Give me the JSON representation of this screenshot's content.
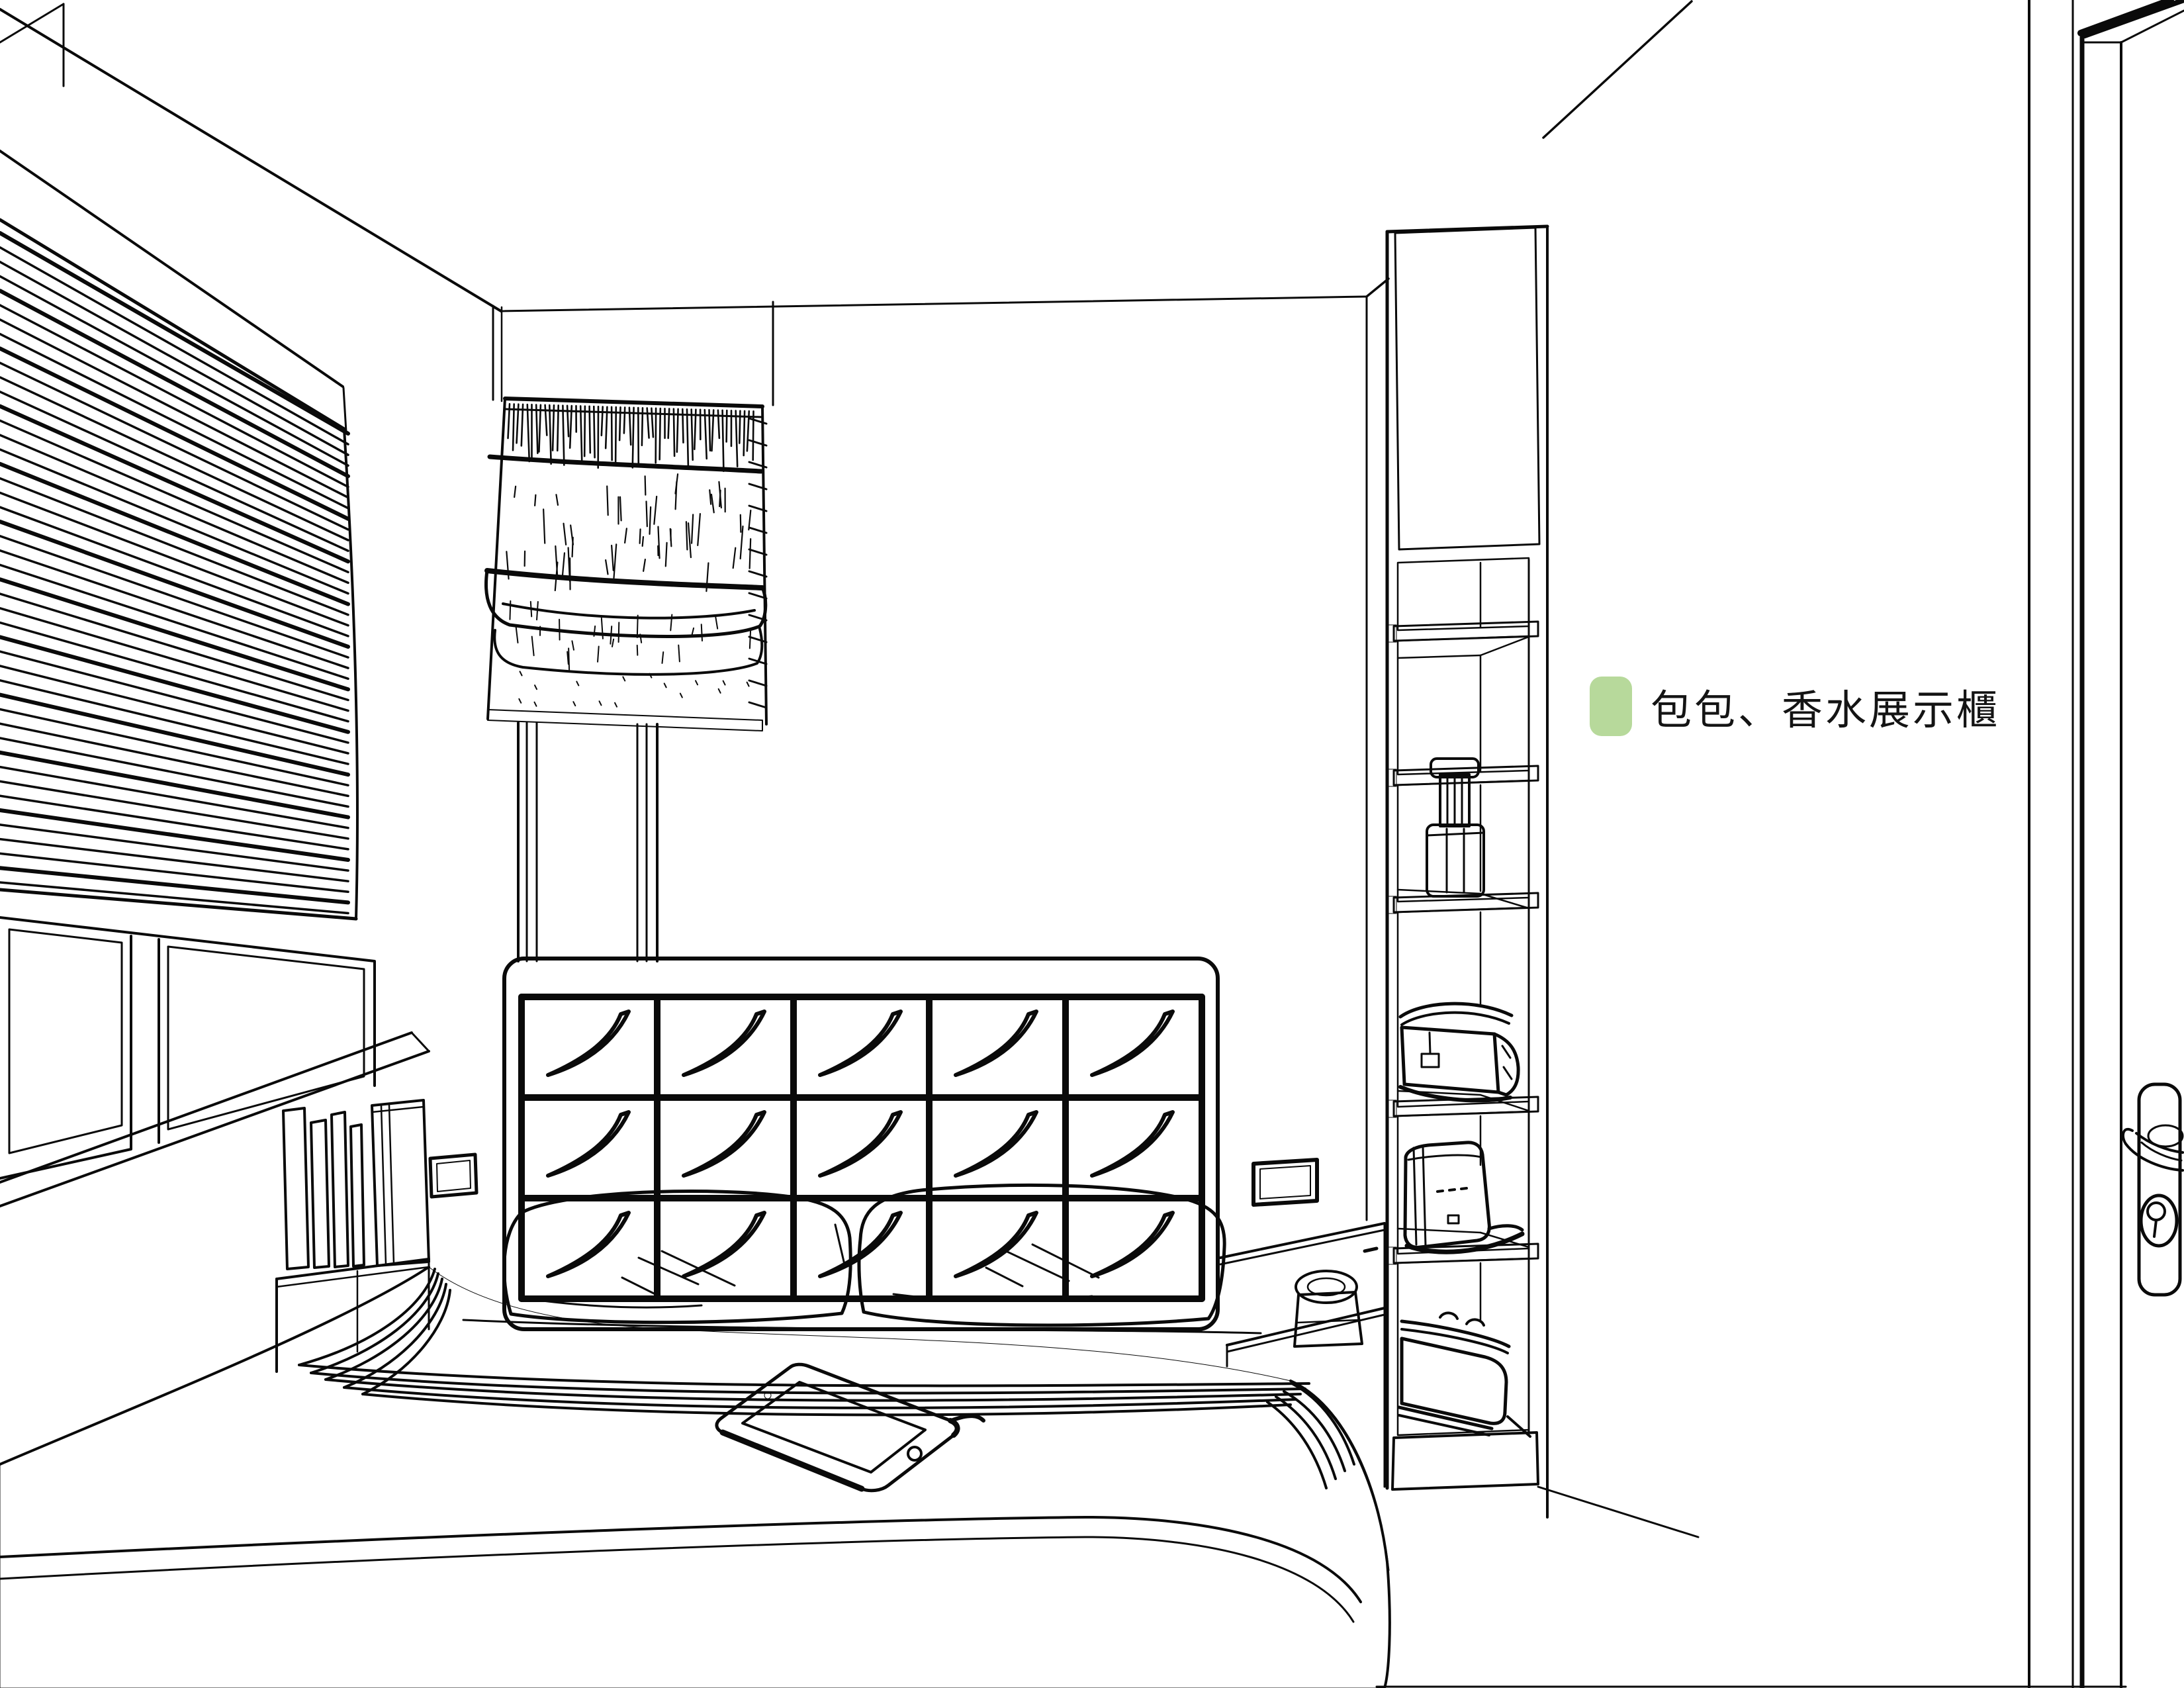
{
  "legend": {
    "label": "包包、香水展示櫃"
  },
  "colors": {
    "highlight_green": "#b4d794",
    "legend_swatch_green": "#b7d99b",
    "item_outline_green": "#3c5a28",
    "line_black": "#0a0a0a",
    "background": "#ffffff"
  },
  "scene_objects": [
    "pleated-blind-window",
    "roman-shade-window",
    "tufted-headboard",
    "pillows",
    "double-bed",
    "tablet-on-bed",
    "books-on-bedside-shelf",
    "wall-switch",
    "bedside-counter-with-clock",
    "bag-and-perfume-display-cabinet",
    "perfume-bottle",
    "clutch-bag",
    "handbag",
    "suitcase",
    "door-with-lever-handle"
  ]
}
